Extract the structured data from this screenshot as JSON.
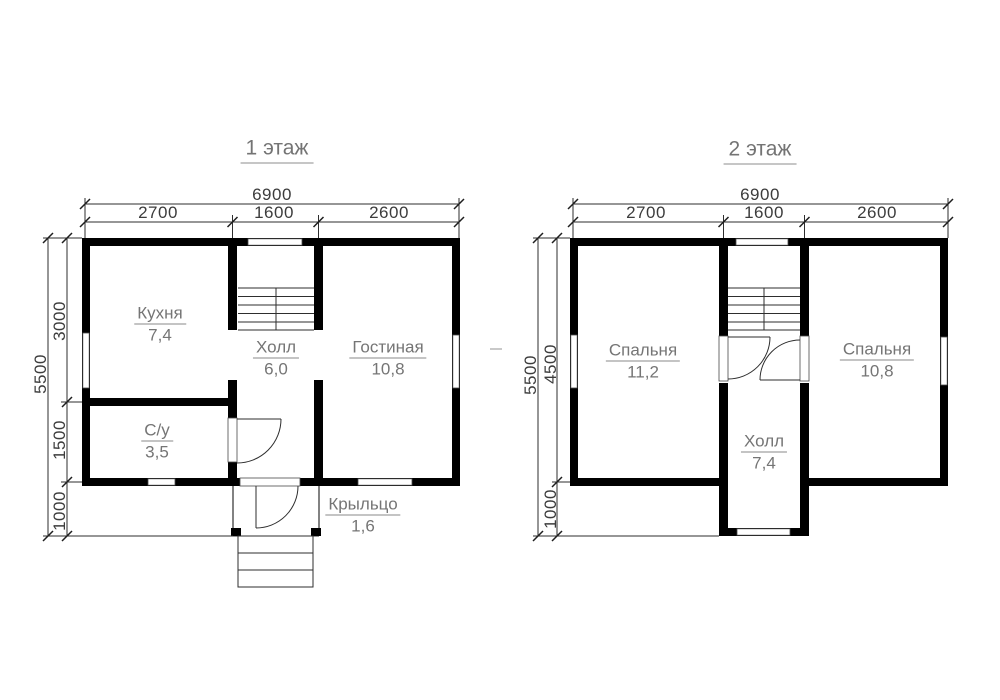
{
  "colors": {
    "wall": "#000000",
    "thin_line": "#2e2e2e",
    "room_label": "#757575",
    "dim_text": "#3c3c3c"
  },
  "floor1": {
    "title": "1 этаж",
    "dims": {
      "total_width": "6900",
      "width_segments": [
        "2700",
        "1600",
        "2600"
      ],
      "total_height": "5500",
      "height_segments": [
        "3000",
        "1500",
        "1000"
      ]
    },
    "rooms": {
      "kitchen": {
        "name": "Кухня",
        "area": "7,4"
      },
      "hall": {
        "name": "Холл",
        "area": "6,0"
      },
      "living": {
        "name": "Гостиная",
        "area": "10,8"
      },
      "bathroom": {
        "name": "С/у",
        "area": "3,5"
      },
      "porch": {
        "name": "Крыльцо",
        "area": "1,6"
      }
    }
  },
  "floor2": {
    "title": "2 этаж",
    "dims": {
      "total_width": "6900",
      "width_segments": [
        "2700",
        "1600",
        "2600"
      ],
      "total_height": "5500",
      "height_segments": [
        "4500",
        "1000"
      ]
    },
    "rooms": {
      "bedroom_left": {
        "name": "Спальня",
        "area": "11,2"
      },
      "bedroom_right": {
        "name": "Спальня",
        "area": "10,8"
      },
      "hall": {
        "name": "Холл",
        "area": "7,4"
      }
    }
  }
}
